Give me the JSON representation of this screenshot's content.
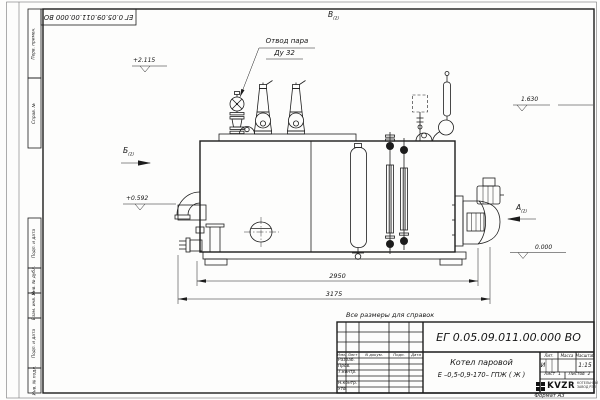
{
  "sheet": {
    "doc_number_inverted": "ЕГ 0.05.09.011.00.000  ВО",
    "note_above_title": "Все размеры для справок",
    "format_label": "Формат А3",
    "margin_top": [
      "Перв. примен.",
      "Справ. №"
    ],
    "margin_bottom": [
      "Подп. и дата",
      "Инв. № дубл.",
      "Взам. инв. №",
      "Подп. и дата",
      "Инв. № подл."
    ]
  },
  "views": {
    "view_b": {
      "letter": "В",
      "sub": "(2)"
    },
    "view_bb": {
      "letter": "Б",
      "sub": "(2)"
    },
    "view_a": {
      "letter": "А",
      "sub": "(2)"
    }
  },
  "elevations": {
    "top": "+2.115",
    "left": "+0.592",
    "right_upper": "1.630",
    "right_lower": "0.000"
  },
  "callout": {
    "line1": "Отвод пара",
    "line2": "Ду 32"
  },
  "dimensions": {
    "inner": "2950",
    "overall": "3175"
  },
  "title_block": {
    "doc_number": "ЕГ 0.05.09.011.00.000  ВО",
    "product_name": "Котел паровой",
    "product_type": "Е –0,5-0,9-170– ГПЖ ( Ж )",
    "cols": {
      "izm": "Изм.",
      "list": "Лист",
      "docum": "N докум.",
      "podp": "Подп.",
      "data": "Дата"
    },
    "rows": [
      "Разраб.",
      "Пров.",
      "Т.контр.",
      "",
      "Н.контр.",
      "Утв."
    ],
    "lit": {
      "header": "Лит.",
      "value": "И"
    },
    "massa": {
      "header": "Масса",
      "value": ""
    },
    "masshtab": {
      "header": "Масштаб",
      "value": "1:15"
    },
    "sheet_no": {
      "label": "Лист",
      "value": "1"
    },
    "sheets_total": {
      "label": "Листов",
      "value": "2"
    },
    "company": {
      "logo": "KVZR",
      "line1": "КОТЕЛЬНЫЙ",
      "line2": "ЗАВОД РЭП"
    }
  }
}
